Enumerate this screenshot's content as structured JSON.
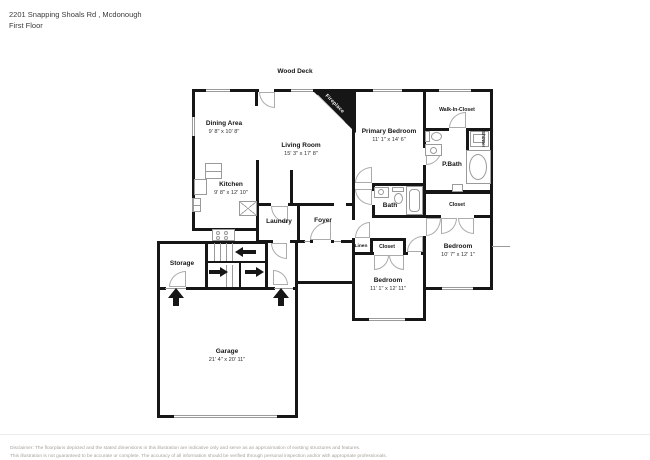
{
  "page": {
    "title_line1": "2201 Snapping Shoals Rd , Mcdonough",
    "title_line2": "First Floor"
  },
  "plan": {
    "deck_label": "Wood Deck",
    "fireplace_label": "Fireplace",
    "rooms": {
      "dining": {
        "name": "Dining Area",
        "dims": "9' 8\" x 10' 8\""
      },
      "living": {
        "name": "Living Room",
        "dims": "15' 3\" x 17' 8\""
      },
      "kitchen": {
        "name": "Kitchen",
        "dims": "9' 8\" x 12' 10\""
      },
      "laundry": {
        "name": "Laundry"
      },
      "foyer": {
        "name": "Foyer"
      },
      "storage": {
        "name": "Storage"
      },
      "garage": {
        "name": "Garage",
        "dims": "21' 4\" x 20' 11\""
      },
      "primary_bedroom": {
        "name": "Primary Bedroom",
        "dims": "11' 1\" x 14' 6\""
      },
      "walk_in_closet": {
        "name": "Walk-In-Closet"
      },
      "pbath": {
        "name": "P.Bath"
      },
      "shower": {
        "name": "Shower"
      },
      "bath": {
        "name": "Bath"
      },
      "closet_right": {
        "name": "Closet"
      },
      "bedroom_right": {
        "name": "Bedroom",
        "dims": "10' 7\" x 12' 1\""
      },
      "linen": {
        "name": "Linen"
      },
      "closet_mid": {
        "name": "Closet"
      },
      "bedroom_mid": {
        "name": "Bedroom",
        "dims": "11' 1\" x 12' 11\""
      }
    }
  },
  "footer": {
    "disclaimer_line1": "Disclaimer: The floorplans depicted and the stated dimensions in this illustration are indicative only and serve as an approximation of existing structures and features.",
    "disclaimer_line2": "This illustration is not guaranteed to be accurate or complete. The accuracy of all information should be verified through personal inspection and/or with appropriate professionals."
  },
  "colors": {
    "wall": "#161616",
    "fixture_line": "#9a9a9a",
    "text": "#161616",
    "disclaimer": "#a8a29b"
  }
}
